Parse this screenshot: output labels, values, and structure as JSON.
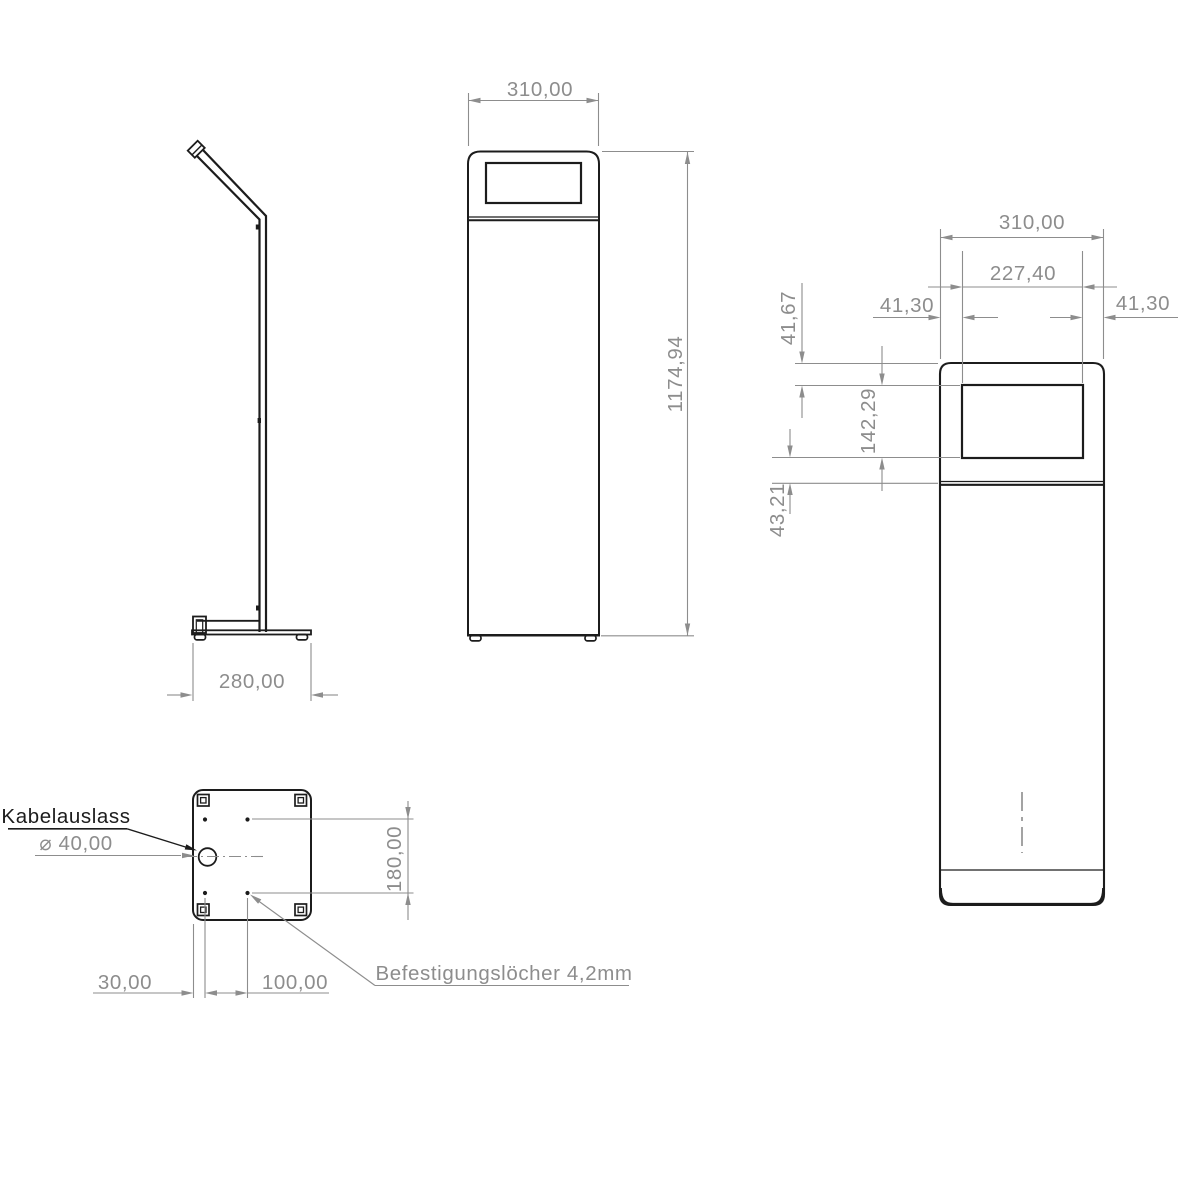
{
  "views": {
    "side": {
      "base_width": "280,00"
    },
    "front": {
      "width": "310,00",
      "height": "1174,94"
    },
    "detail": {
      "width": "310,00",
      "cutout_width": "227,40",
      "left_margin": "41,30",
      "right_margin": "41,30",
      "top_margin": "41,67",
      "cutout_height": "142,29",
      "cutout_to_seam": "43,21"
    },
    "base": {
      "cable_label": "Kabelauslass",
      "cable_diameter": "⌀ 40,00",
      "hole_spacing_y": "180,00",
      "edge_to_hole_x": "30,00",
      "hole_spacing_x": "100,00",
      "mounting_label": "Befestigungslöcher 4,2mm"
    }
  },
  "colors": {
    "outline": "#1c1c1c",
    "dimension": "#8d8d8d",
    "background": "#ffffff"
  }
}
